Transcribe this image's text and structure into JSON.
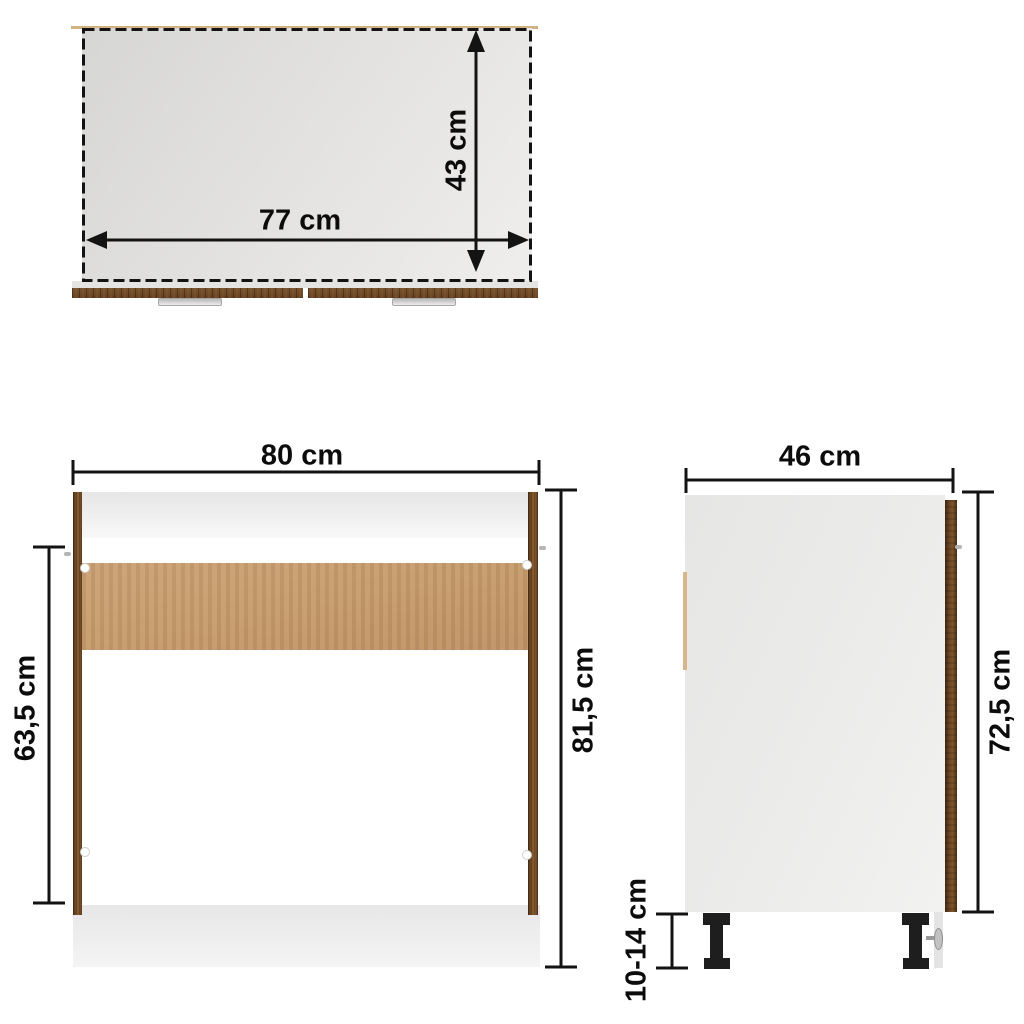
{
  "views": {
    "top_view": {
      "width": {
        "label": "77 cm"
      },
      "depth": {
        "label": "43 cm"
      }
    },
    "front_view": {
      "width": {
        "label": "80 cm"
      },
      "opening_height": {
        "label": "63,5 cm"
      },
      "total_height": {
        "label": "81,5 cm"
      }
    },
    "side_view": {
      "depth": {
        "label": "46 cm"
      },
      "body_height": {
        "label": "72,5 cm"
      },
      "leg_height": {
        "label": "10-14 cm"
      }
    }
  },
  "colors": {
    "background": "#ffffff",
    "dimension_line": "#131313",
    "label_text": "#0c0c0c",
    "wood_dark": "#6f4a26",
    "wood_tan": "#c49c6e",
    "panel_gray": "#e9e9e8",
    "worktop_gray": "#dededc",
    "leg_black": "#1e1e1e"
  }
}
